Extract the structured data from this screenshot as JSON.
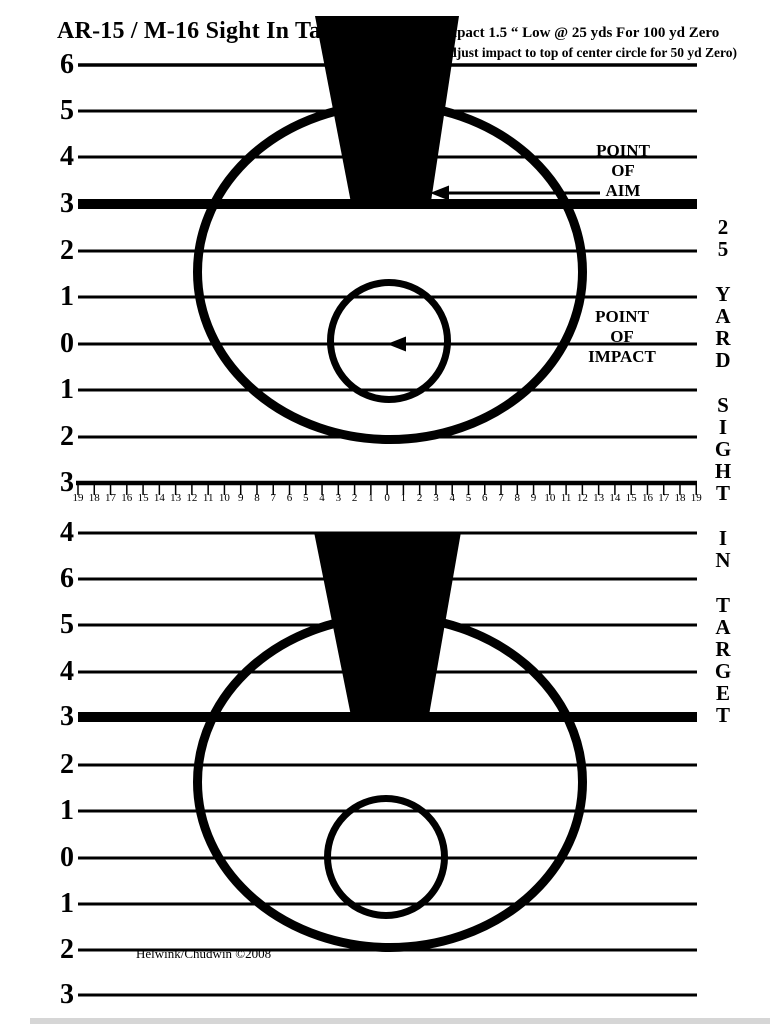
{
  "header": {
    "title": "AR-15 / M-16 Sight In Target",
    "impact_line1": "Impact 1.5 “ Low @ 25 yds  For 100 yd Zero",
    "impact_line2": "(adjust impact to top of center circle for 50 yd Zero)"
  },
  "annotations": {
    "point_of_aim": [
      "POINT",
      "OF",
      "AIM"
    ],
    "point_of_impact": [
      "POINT",
      "OF",
      "IMPACT"
    ]
  },
  "left_scale_top": [
    "6",
    "5",
    "4",
    "3",
    "2",
    "1",
    "0",
    "1",
    "2",
    "3"
  ],
  "left_scale_mid": "4",
  "left_scale_bottom": [
    "6",
    "5",
    "4",
    "3",
    "2",
    "1",
    "0",
    "1",
    "2",
    "3"
  ],
  "ruler_numbers": [
    "19",
    "18",
    "17",
    "16",
    "15",
    "14",
    "13",
    "12",
    "11",
    "10",
    "9",
    "8",
    "7",
    "6",
    "5",
    "4",
    "3",
    "2",
    "1",
    "0",
    "1",
    "2",
    "3",
    "4",
    "5",
    "6",
    "7",
    "8",
    "9",
    "10",
    "11",
    "12",
    "13",
    "14",
    "15",
    "16",
    "17",
    "18",
    "19"
  ],
  "side_text_words": [
    "25",
    "YARD",
    "SIGHT",
    "IN",
    "TARGET"
  ],
  "footer": {
    "copyright": "Helwink/Chudwin ©2008"
  },
  "colors": {
    "ink": "#000000",
    "paper": "#ffffff"
  }
}
